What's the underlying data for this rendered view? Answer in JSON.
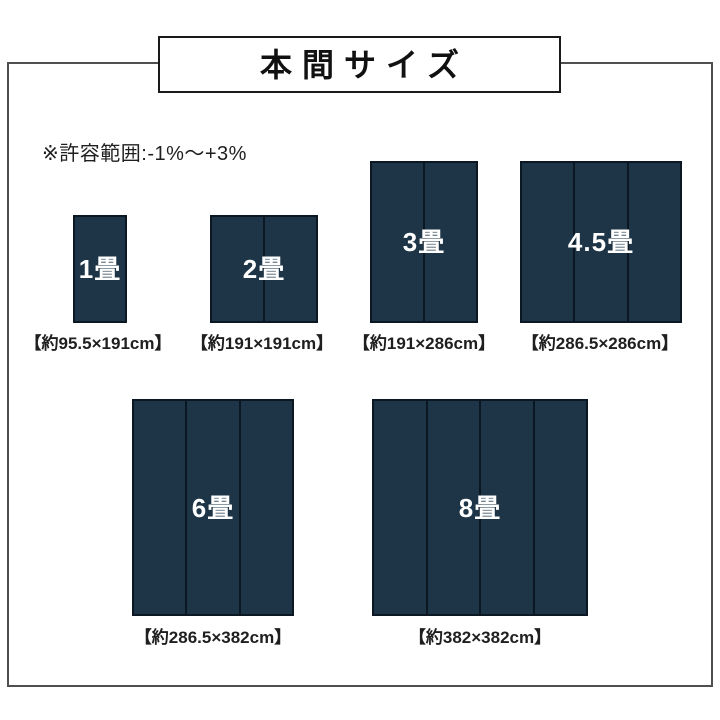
{
  "header": {
    "title": "本間サイズ"
  },
  "note": {
    "text": "※許容範囲:-1%〜+3%"
  },
  "mats": [
    {
      "id": "1jo",
      "label": "1畳",
      "dims": "【約95.5×191cm】",
      "panels": 1
    },
    {
      "id": "2jo",
      "label": "2畳",
      "dims": "【約191×191cm】",
      "panels": 2
    },
    {
      "id": "3jo",
      "label": "3畳",
      "dims": "【約191×286cm】",
      "panels": 2
    },
    {
      "id": "45jo",
      "label": "4.5畳",
      "dims": "【約286.5×286cm】",
      "panels": 3
    },
    {
      "id": "6jo",
      "label": "6畳",
      "dims": "【約286.5×382cm】",
      "panels": 3
    },
    {
      "id": "8jo",
      "label": "8畳",
      "dims": "【約382×382cm】",
      "panels": 4
    }
  ],
  "colors": {
    "mat_fill": "#1d3547",
    "mat_border": "#0b1823",
    "frame_border": "#4f4f4f",
    "title_border": "#1a1a1a",
    "text": "#1f1f1f",
    "label_text": "#ffffff",
    "page_bg": "#ffffff"
  }
}
